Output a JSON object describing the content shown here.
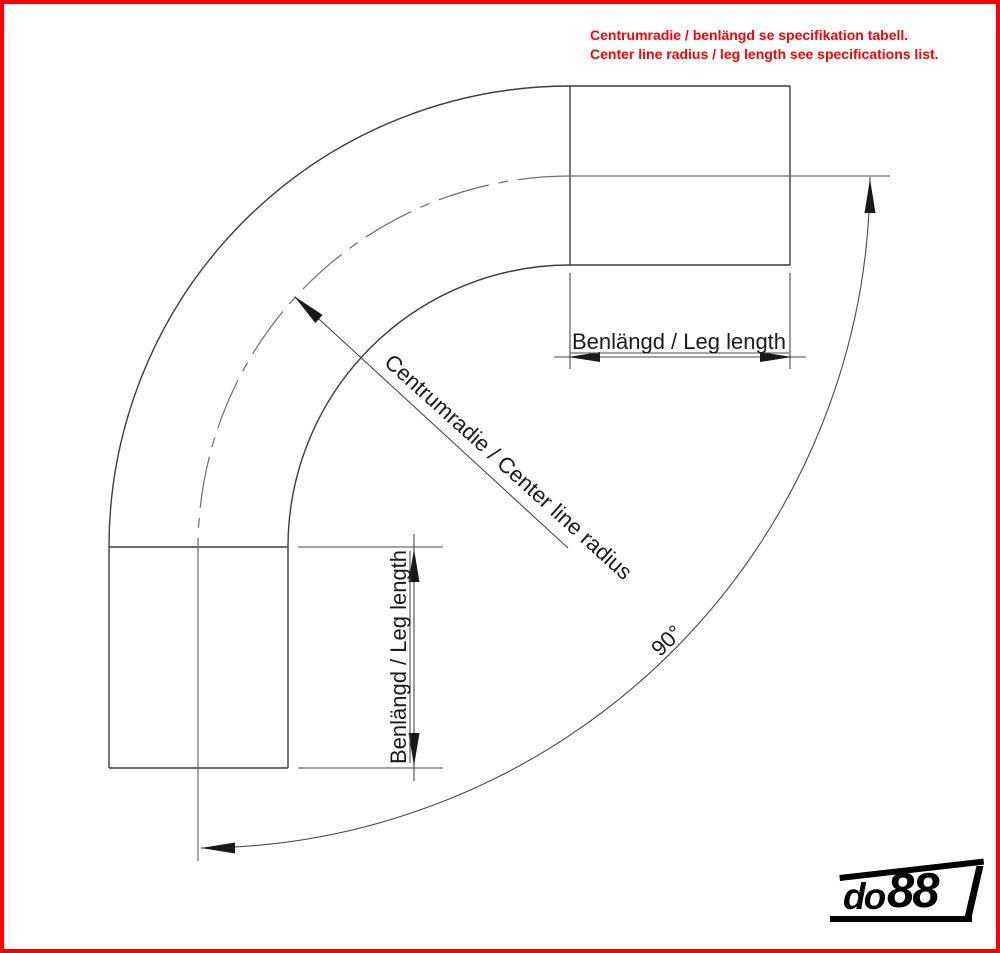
{
  "frame": {
    "border_color": "#fe0000",
    "background": "#ffffff"
  },
  "notice": {
    "line_sv": "Centrumradie / benlängd se specifikation tabell.",
    "line_en": "Center line radius / leg length see specifications list.",
    "color": "#fe0000"
  },
  "drawing": {
    "type": "technical-drawing-90-degree-pipe-bend",
    "labels": {
      "leg_top": "Benlängd / Leg length",
      "leg_left": "Benlängd / Leg length",
      "center_radius": "Centrumradie / Center line radius",
      "angle": "90°"
    },
    "line_color": "#3d3d3d",
    "centerline_color": "#6e6e6e",
    "text_color": "#1b1b1b"
  },
  "logo": {
    "prefix": "do",
    "suffix": "88",
    "color": "#000000"
  }
}
